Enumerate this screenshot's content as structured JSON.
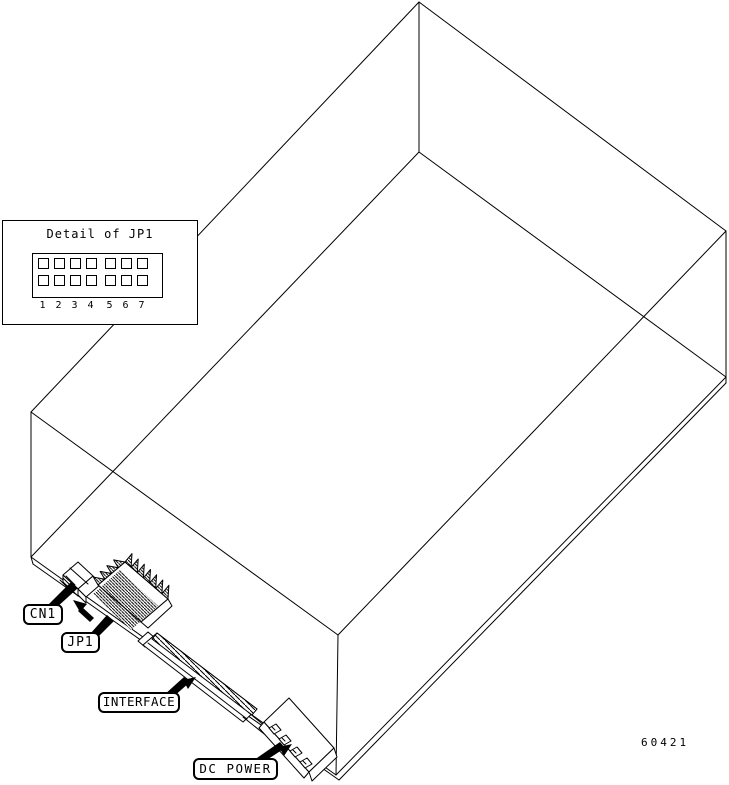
{
  "figure": {
    "number": "60421"
  },
  "detail_inset": {
    "title": "Detail of JP1",
    "rows": 2,
    "cols": 7,
    "pin_numbers": [
      "1",
      "2",
      "3",
      "4",
      "5",
      "6",
      "7"
    ]
  },
  "callouts": {
    "cn1": "CN1",
    "jp1": "JP1",
    "interface": "INTERFACE",
    "dc_power": "DC POWER"
  },
  "colors": {
    "line": "#000000",
    "background": "#ffffff"
  }
}
